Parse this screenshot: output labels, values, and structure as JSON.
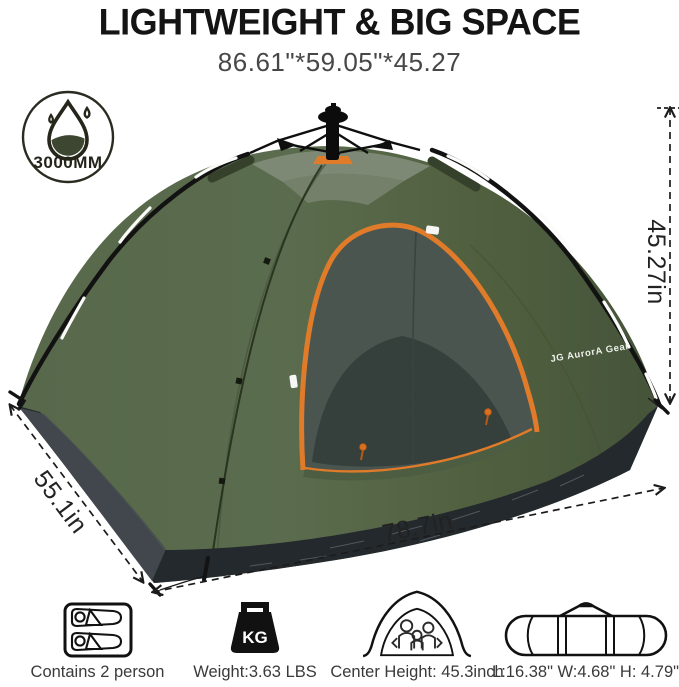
{
  "header": {
    "title": "LIGHTWEIGHT & BIG SPACE",
    "subtitle": "86.61\"*59.05\"*45.27"
  },
  "waterproof_badge": {
    "icon": "water-drop-icon",
    "rating": "3000MM"
  },
  "tent": {
    "brand_label": "JG AurorA Gear",
    "type": "pop-up dome tent"
  },
  "dimension_labels": {
    "height": "45.27in",
    "depth": "55.1in",
    "length": "78.7in"
  },
  "features": [
    {
      "icon": "two-sleepers-icon",
      "label": "Contains 2 person"
    },
    {
      "icon": "kg-weight-icon",
      "icon_text": "KG",
      "label": "Weight:3.63 LBS"
    },
    {
      "icon": "tent-family-icon",
      "label": "Center Height: 45.3inch"
    },
    {
      "icon": "carry-bag-icon",
      "label": "L:16.38\" W:4.68\" H: 4.79\""
    }
  ],
  "colors": {
    "tent_green": "#56684a",
    "tent_green_dark": "#4a5a3e",
    "top_panel_gray": "#7e8975",
    "accent_orange": "#e07b2a",
    "tarp_black": "#24292d",
    "mesh_gray": "#4a5550",
    "ink": "#1c1c1c"
  }
}
